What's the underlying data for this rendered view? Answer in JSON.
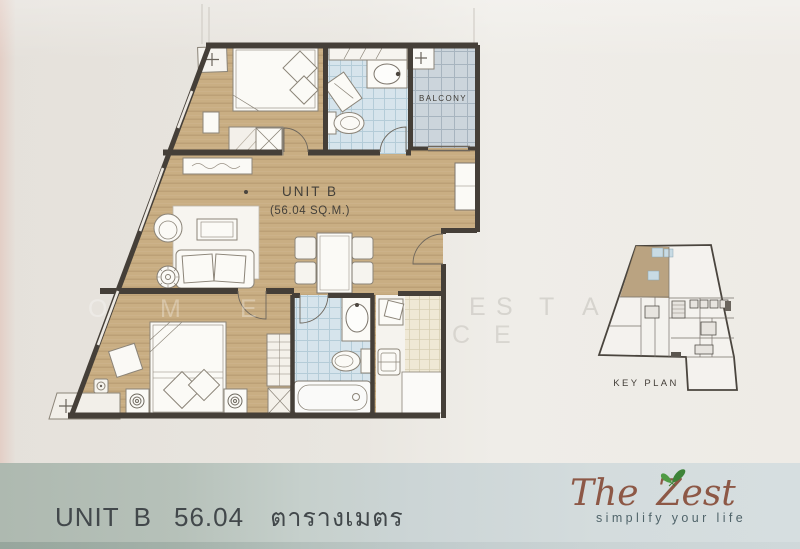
{
  "plan": {
    "unit_label": "UNIT B",
    "unit_area": "(56.04 SQ.M.)",
    "balcony_label": "BALCONY"
  },
  "key_plan": {
    "label": "KEY PLAN"
  },
  "watermark": {
    "part1": "OME",
    "part2": "ESTA",
    "part3": "CE"
  },
  "footer": {
    "unit_label": "UNIT B",
    "area_value": "56.04",
    "area_unit": "ตารางเมตร",
    "brand_the": "The",
    "brand_zest": "Zest",
    "tagline": "simplify your life"
  },
  "colors": {
    "wood": "#c9ae83",
    "wall": "#453f38",
    "bath_tile": "#d6e4ec",
    "balcony_tile": "#ccd5dc",
    "kitchen_tile": "#efe8d5",
    "brand_brown": "#8d5846",
    "butterfly_green": "#4f9b44",
    "footer_left": "#aeb9b0",
    "footer_right": "#d6dee0",
    "keyplan_highlight": "#b49a74"
  }
}
